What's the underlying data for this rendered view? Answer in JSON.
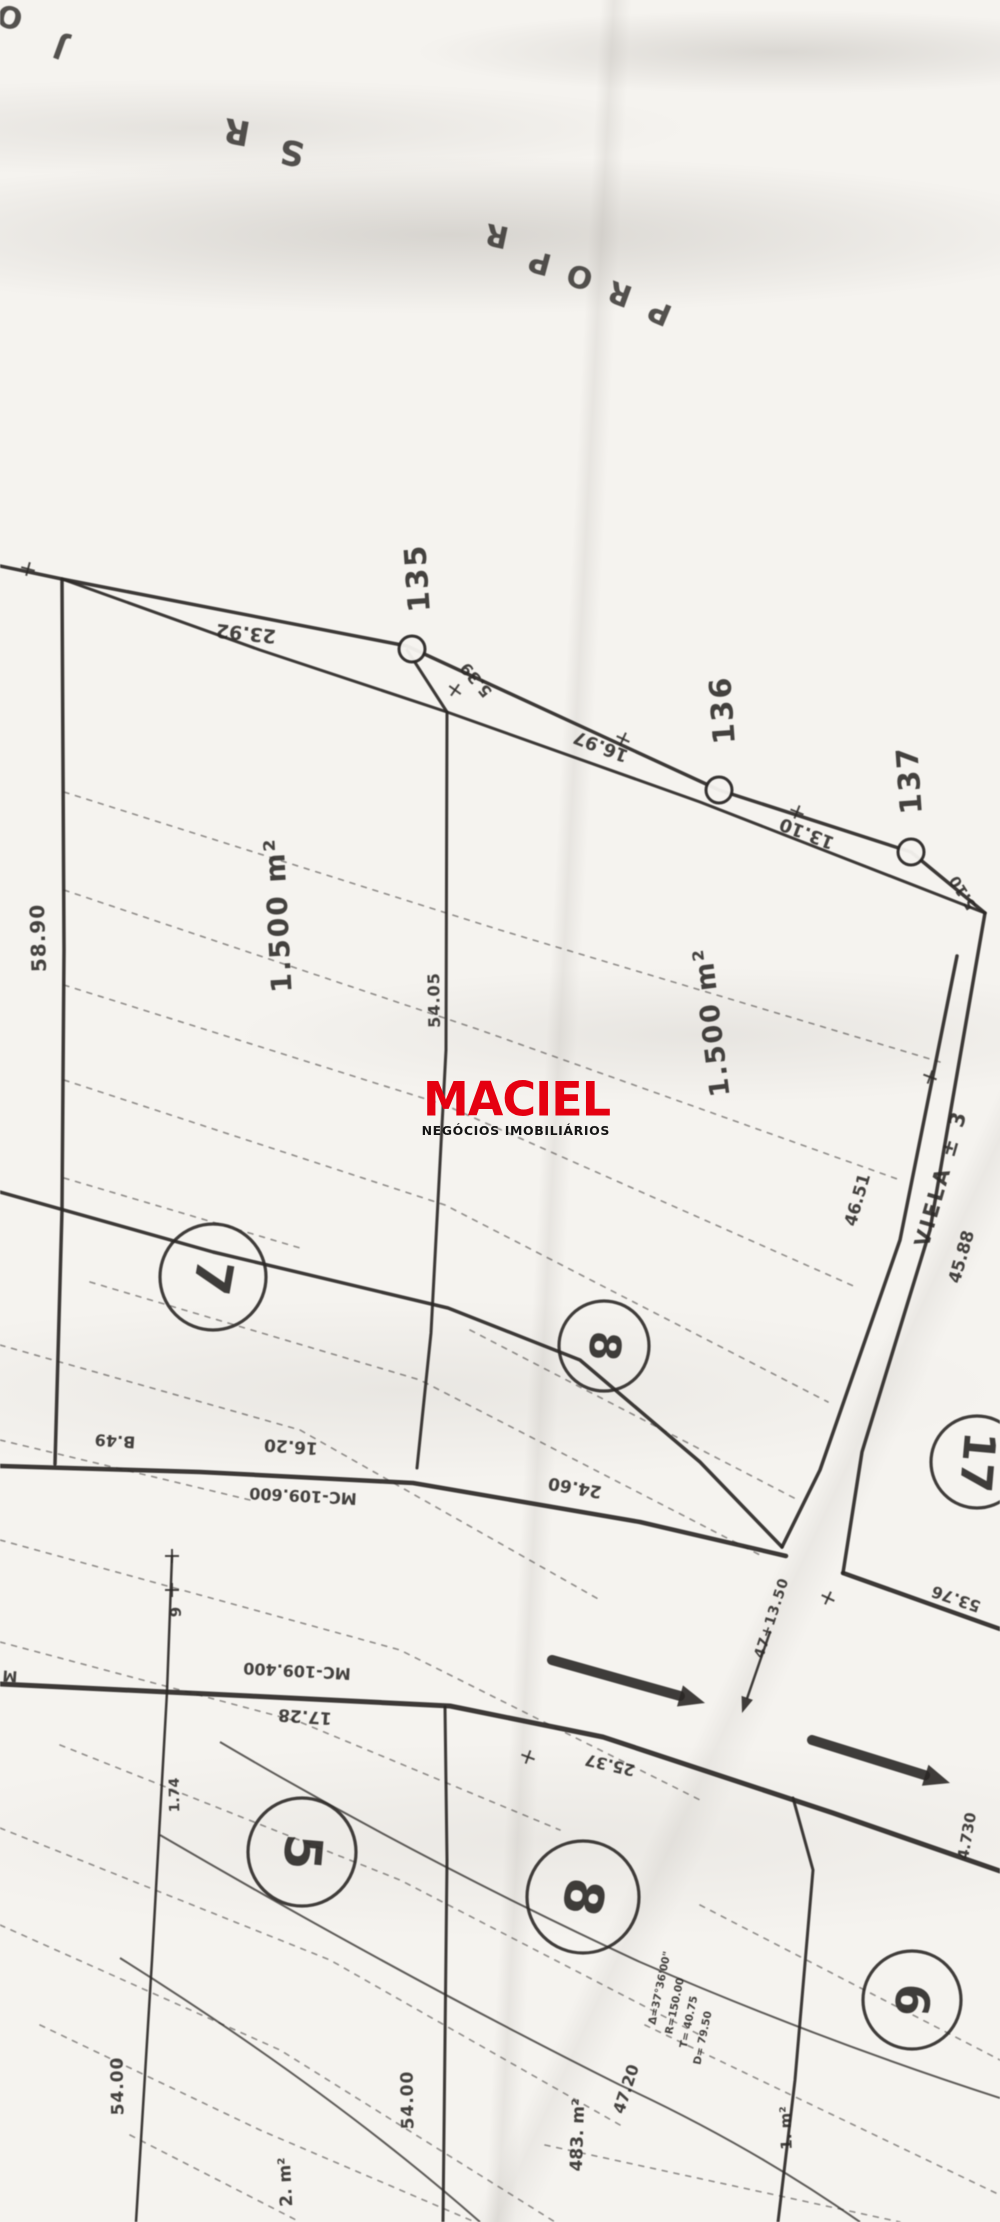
{
  "page": {
    "width": 1000,
    "height": 2222,
    "paper_color": "#f5f3ef",
    "ink_color": "#2b2826"
  },
  "watermark": {
    "brand": "MACIEL",
    "subtitle": "NEGÓCIOS IMOBILIÁRIOS",
    "brand_color": "#e50010",
    "subtitle_color": "#151515"
  },
  "map": {
    "labels": [
      {
        "t": "O",
        "x": 10,
        "y": 16,
        "r": 195,
        "s": 30,
        "w": 700,
        "o": 0.8
      },
      {
        "t": "J",
        "x": 60,
        "y": 47,
        "r": 200,
        "s": 30,
        "w": 700,
        "o": 0.8
      },
      {
        "t": "R",
        "x": 237,
        "y": 131,
        "r": 190,
        "s": 34,
        "w": 700,
        "o": 0.8
      },
      {
        "t": "S",
        "x": 292,
        "y": 152,
        "r": 190,
        "s": 34,
        "w": 700,
        "o": 0.8
      },
      {
        "t": "R",
        "x": 497,
        "y": 235,
        "r": 192,
        "s": 30,
        "w": 700,
        "o": 0.8
      },
      {
        "t": "P",
        "x": 540,
        "y": 262,
        "r": 195,
        "s": 30,
        "w": 700,
        "o": 0.8
      },
      {
        "t": "O",
        "x": 580,
        "y": 276,
        "r": 197,
        "s": 30,
        "w": 700,
        "o": 0.8
      },
      {
        "t": "R",
        "x": 620,
        "y": 293,
        "r": 200,
        "s": 30,
        "w": 700,
        "o": 0.8
      },
      {
        "t": "P",
        "x": 660,
        "y": 312,
        "r": 203,
        "s": 30,
        "w": 700,
        "o": 0.8
      },
      {
        "t": "23.92",
        "x": 246,
        "y": 633,
        "r": 186,
        "s": 19
      },
      {
        "t": "135",
        "x": 418,
        "y": 578,
        "r": -94,
        "s": 30,
        "ls": 2
      },
      {
        "t": "5.39",
        "x": 476,
        "y": 680,
        "r": 230,
        "s": 16
      },
      {
        "t": "16.97",
        "x": 601,
        "y": 746,
        "r": 201,
        "s": 18
      },
      {
        "t": "136",
        "x": 723,
        "y": 710,
        "r": -94,
        "s": 30,
        "ls": 2
      },
      {
        "t": "13.10",
        "x": 807,
        "y": 833,
        "r": 201,
        "s": 18
      },
      {
        "t": "137",
        "x": 910,
        "y": 780,
        "r": -94,
        "s": 30,
        "ls": 2
      },
      {
        "t": "5.10",
        "x": 963,
        "y": 893,
        "r": -122,
        "s": 15
      },
      {
        "t": "58.90",
        "x": 38,
        "y": 938,
        "r": -92,
        "s": 20,
        "ls": 1
      },
      {
        "t": "1.500 m²",
        "x": 278,
        "y": 915,
        "r": -93,
        "s": 28,
        "ls": 2
      },
      {
        "t": "54.05",
        "x": 434,
        "y": 1000,
        "r": -91,
        "s": 16,
        "ls": 1
      },
      {
        "t": "1.500 m²",
        "x": 712,
        "y": 1022,
        "r": -97,
        "s": 27,
        "ls": 2
      },
      {
        "t": "46.51",
        "x": 858,
        "y": 1200,
        "r": -74,
        "s": 17
      },
      {
        "t": "VIELA ± 3",
        "x": 941,
        "y": 1178,
        "r": -74,
        "s": 21,
        "ls": 3
      },
      {
        "t": "45.88",
        "x": 962,
        "y": 1257,
        "r": -74,
        "s": 17
      },
      {
        "t": "B.49",
        "x": 115,
        "y": 1441,
        "r": 184,
        "s": 16
      },
      {
        "t": "16.20",
        "x": 291,
        "y": 1446,
        "r": 184,
        "s": 17
      },
      {
        "t": "MC-109.600",
        "x": 303,
        "y": 1496,
        "r": 183,
        "s": 16
      },
      {
        "t": "24.60",
        "x": 575,
        "y": 1487,
        "r": 190,
        "s": 17
      },
      {
        "t": "53.76",
        "x": 956,
        "y": 1599,
        "r": 199,
        "s": 16
      },
      {
        "t": "9",
        "x": 176,
        "y": 1612,
        "r": -90,
        "s": 15
      },
      {
        "t": "47+13.50",
        "x": 772,
        "y": 1618,
        "r": -72,
        "s": 14,
        "ls": 1
      },
      {
        "t": "MC-109.400",
        "x": 297,
        "y": 1671,
        "r": 183,
        "s": 16
      },
      {
        "t": "17.28",
        "x": 305,
        "y": 1716,
        "r": 184,
        "s": 17
      },
      {
        "t": "M",
        "x": 10,
        "y": 1676,
        "r": 184,
        "s": 15
      },
      {
        "t": "1.74",
        "x": 175,
        "y": 1795,
        "r": -91,
        "s": 14
      },
      {
        "t": "25.37",
        "x": 610,
        "y": 1765,
        "r": 193,
        "s": 16
      },
      {
        "t": "4.730",
        "x": 967,
        "y": 1836,
        "r": -80,
        "s": 15
      },
      {
        "t": "54.00",
        "x": 118,
        "y": 2086,
        "r": -91,
        "s": 17,
        "ls": 1
      },
      {
        "t": "2. m²",
        "x": 286,
        "y": 2182,
        "r": -93,
        "s": 17
      },
      {
        "t": "54.00",
        "x": 408,
        "y": 2100,
        "r": -91,
        "s": 17,
        "ls": 1
      },
      {
        "t": "483. m²",
        "x": 578,
        "y": 2135,
        "r": -88,
        "s": 17
      },
      {
        "t": "47.20",
        "x": 626,
        "y": 2089,
        "r": -72,
        "s": 16
      },
      {
        "t": "Δ=37°36'00\"",
        "x": 660,
        "y": 1988,
        "r": -78,
        "s": 10.5
      },
      {
        "t": "R=150.00",
        "x": 675,
        "y": 2006,
        "r": -78,
        "s": 10.5
      },
      {
        "t": "T= 40.75",
        "x": 689,
        "y": 2022,
        "r": -78,
        "s": 10.5
      },
      {
        "t": "D= 79.50",
        "x": 703,
        "y": 2038,
        "r": -78,
        "s": 10.5
      },
      {
        "t": "1. m²",
        "x": 786,
        "y": 2128,
        "r": -92,
        "s": 15
      }
    ],
    "survey_points": [
      {
        "id": "135",
        "x": 412,
        "y": 649,
        "r": 13
      },
      {
        "id": "136",
        "x": 719,
        "y": 790,
        "r": 13
      },
      {
        "id": "137",
        "x": 911,
        "y": 852,
        "r": 13
      }
    ],
    "lot_circles": [
      {
        "num": "7",
        "x": 213,
        "y": 1277,
        "r": 53,
        "rot": 100
      },
      {
        "num": "8",
        "x": 604,
        "y": 1346,
        "r": 45,
        "rot": 95
      },
      {
        "num": "17",
        "x": 977,
        "y": 1462,
        "r": 46,
        "rot": 95
      },
      {
        "num": "5",
        "x": 302,
        "y": 1852,
        "r": 54,
        "rot": 95
      },
      {
        "num": "8",
        "x": 583,
        "y": 1897,
        "r": 56,
        "rot": 100
      },
      {
        "num": "6",
        "x": 912,
        "y": 2000,
        "r": 49,
        "rot": 95
      }
    ],
    "solid_lines": [
      {
        "pts": [
          [
            0,
            566
          ],
          [
            62,
            579
          ],
          [
            407,
            646
          ],
          [
            719,
            790
          ],
          [
            911,
            852
          ],
          [
            985,
            913
          ]
        ],
        "w": 3.5
      },
      {
        "pts": [
          [
            62,
            579
          ],
          [
            260,
            650
          ],
          [
            447,
            712
          ],
          [
            700,
            802
          ],
          [
            985,
            913
          ]
        ],
        "w": 3
      },
      {
        "pts": [
          [
            407,
            650
          ],
          [
            447,
            712
          ]
        ],
        "w": 3
      },
      {
        "pts": [
          [
            62,
            579
          ],
          [
            64,
            950
          ],
          [
            62,
            1210
          ],
          [
            55,
            1464
          ]
        ],
        "w": 3.5
      },
      {
        "pts": [
          [
            447,
            712
          ],
          [
            446,
            1050
          ],
          [
            431,
            1333
          ],
          [
            417,
            1468
          ]
        ],
        "w": 3
      },
      {
        "pts": [
          [
            0,
            1192
          ],
          [
            213,
            1252
          ],
          [
            448,
            1308
          ],
          [
            580,
            1360
          ],
          [
            700,
            1462
          ],
          [
            782,
            1547
          ]
        ],
        "w": 3.5
      },
      {
        "pts": [
          [
            957,
            956
          ],
          [
            900,
            1240
          ],
          [
            820,
            1470
          ],
          [
            782,
            1547
          ]
        ],
        "w": 3.5
      },
      {
        "pts": [
          [
            985,
            913
          ],
          [
            930,
            1230
          ],
          [
            862,
            1452
          ],
          [
            843,
            1573
          ]
        ],
        "w": 3.5
      },
      {
        "pts": [
          [
            0,
            1466
          ],
          [
            200,
            1472
          ],
          [
            413,
            1483
          ],
          [
            640,
            1522
          ],
          [
            786,
            1556
          ]
        ],
        "w": 4.5
      },
      {
        "pts": [
          [
            843,
            1573
          ],
          [
            983,
            1623
          ],
          [
            1000,
            1629
          ]
        ],
        "w": 4.5
      },
      {
        "pts": [
          [
            0,
            1684
          ],
          [
            250,
            1696
          ],
          [
            450,
            1706
          ],
          [
            603,
            1737
          ],
          [
            727,
            1778
          ],
          [
            833,
            1813
          ],
          [
            1000,
            1871
          ]
        ],
        "w": 5
      },
      {
        "pts": [
          [
            172,
            1556
          ],
          [
            167,
            1692
          ],
          [
            152,
            1960
          ],
          [
            136,
            2222
          ]
        ],
        "w": 2.5
      },
      {
        "pts": [
          [
            445,
            1707
          ],
          [
            447,
            1860
          ],
          [
            443,
            2222
          ]
        ],
        "w": 3
      },
      {
        "pts": [
          [
            793,
            1798
          ],
          [
            813,
            1870
          ],
          [
            795,
            2080
          ],
          [
            778,
            2222
          ]
        ],
        "w": 3
      }
    ],
    "curves": [
      {
        "d": "M220,1742 Q420,1860 640,1962 Q820,2040 1000,2098",
        "w": 2
      },
      {
        "d": "M160,1835 Q400,1975 620,2085 Q750,2145 860,2222",
        "w": 2
      },
      {
        "d": "M120,1958 Q330,2090 480,2222",
        "w": 2
      }
    ],
    "dashed_lines": [
      {
        "pts": [
          [
            64,
            792
          ],
          [
            500,
            930
          ],
          [
            940,
            1062
          ]
        ]
      },
      {
        "pts": [
          [
            64,
            890
          ],
          [
            480,
            1030
          ],
          [
            900,
            1180
          ]
        ]
      },
      {
        "pts": [
          [
            64,
            985
          ],
          [
            445,
            1105
          ],
          [
            858,
            1288
          ]
        ]
      },
      {
        "pts": [
          [
            64,
            1080
          ],
          [
            445,
            1205
          ],
          [
            828,
            1402
          ]
        ]
      },
      {
        "pts": [
          [
            64,
            1178
          ],
          [
            300,
            1248
          ]
        ]
      },
      {
        "pts": [
          [
            470,
            1330
          ],
          [
            798,
            1500
          ]
        ]
      },
      {
        "pts": [
          [
            90,
            1282
          ],
          [
            420,
            1380
          ],
          [
            760,
            1555
          ]
        ]
      },
      {
        "pts": [
          [
            0,
            1345
          ],
          [
            300,
            1430
          ],
          [
            600,
            1600
          ]
        ]
      },
      {
        "pts": [
          [
            0,
            1440
          ],
          [
            250,
            1500
          ]
        ]
      },
      {
        "pts": [
          [
            0,
            1540
          ],
          [
            400,
            1650
          ],
          [
            700,
            1800
          ]
        ]
      },
      {
        "pts": [
          [
            0,
            1642
          ],
          [
            300,
            1722
          ],
          [
            560,
            1830
          ]
        ]
      },
      {
        "pts": [
          [
            60,
            1745
          ],
          [
            400,
            1880
          ],
          [
            700,
            2035
          ]
        ]
      },
      {
        "pts": [
          [
            0,
            1828
          ],
          [
            330,
            1960
          ],
          [
            620,
            2125
          ]
        ]
      },
      {
        "pts": [
          [
            0,
            1925
          ],
          [
            280,
            2050
          ],
          [
            555,
            2222
          ]
        ]
      },
      {
        "pts": [
          [
            40,
            2025
          ],
          [
            260,
            2130
          ],
          [
            475,
            2222
          ]
        ]
      },
      {
        "pts": [
          [
            130,
            2135
          ],
          [
            300,
            2222
          ]
        ]
      },
      {
        "pts": [
          [
            700,
            1905
          ],
          [
            1000,
            2060
          ]
        ]
      },
      {
        "pts": [
          [
            645,
            2025
          ],
          [
            1000,
            2195
          ]
        ]
      },
      {
        "pts": [
          [
            545,
            2145
          ],
          [
            900,
            2222
          ]
        ]
      }
    ],
    "ticks": [
      [
        28,
        569,
        15
      ],
      [
        455,
        690,
        35
      ],
      [
        623,
        739,
        25
      ],
      [
        797,
        812,
        22
      ],
      [
        930,
        1077,
        -70
      ],
      [
        172,
        1556,
        0
      ],
      [
        172,
        1590,
        0
      ],
      [
        528,
        1757,
        20
      ],
      [
        828,
        1598,
        -65
      ]
    ],
    "arrows": [
      {
        "x1": 552,
        "y1": 1660,
        "x2": 705,
        "y2": 1703,
        "w": 10
      },
      {
        "x1": 812,
        "y1": 1740,
        "x2": 950,
        "y2": 1783,
        "w": 10
      },
      {
        "x1": 770,
        "y1": 1632,
        "x2": 742,
        "y2": 1713,
        "w": 2.5
      }
    ]
  }
}
